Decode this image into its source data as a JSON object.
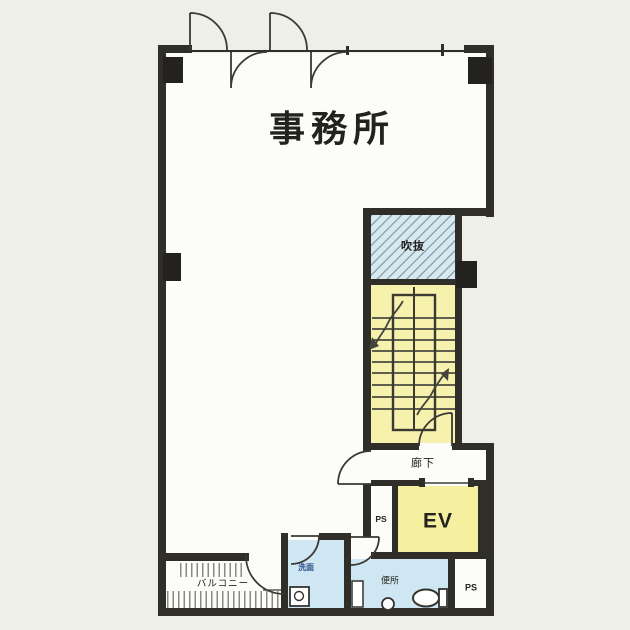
{
  "plan": {
    "title": "floor-plan",
    "rooms": {
      "office": "事務所",
      "void": "吹抜",
      "corridor": "廊下",
      "elevator": "EV",
      "pipe_space_upper": "PS",
      "pipe_space_lower": "PS",
      "toilet": "便所",
      "washroom": "洗面",
      "balcony": "バルコニー"
    },
    "icons": {
      "toilet_fixture": "toilet-bowl-icon",
      "hand_basin": "hand-basin-icon",
      "sink": "sink-icon",
      "stair_direction": "stair-arrow-icon"
    },
    "colors": {
      "wall": "#2f2e29",
      "paper": "#fcfcf9",
      "background": "#edefe8",
      "stairs_fill": "#f6f2ad",
      "elevator_fill": "#f4f09f",
      "void_fill": "#d7e9f0",
      "wet_area_fill": "#cfe7f2"
    }
  }
}
